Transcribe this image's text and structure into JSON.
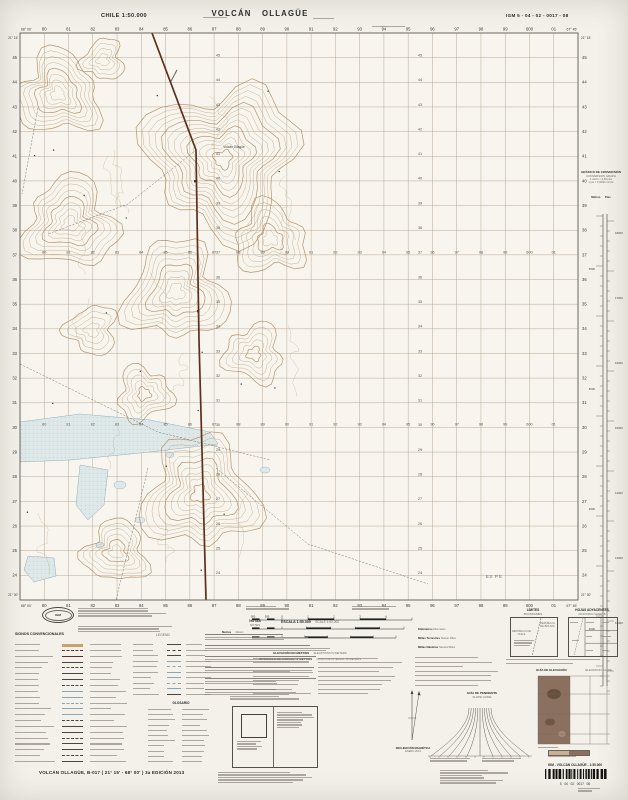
{
  "colors": {
    "paper": "#f7f5ee",
    "grid_line": "#b3a18d",
    "contour": "#b08a5e",
    "road": "#5f2f1d",
    "water_fill": "#dfe8e8",
    "water_line": "#8aa7b4",
    "ink": "#2a2a28",
    "gray": "#6f6b64"
  },
  "header": {
    "country_scale": "CHILE 1:50.000",
    "title": "VOLCÁN OLLAGÜE",
    "sheet_code": "IGM 5 - 04 - 02 - 0017 - 08"
  },
  "map": {
    "corners": {
      "nw_lon": "68° 00'",
      "nw_lat": "21° 15'",
      "ne_lon": "67° 45'",
      "ne_lat": "21° 15'",
      "sw_lon": "68° 00'",
      "sw_lat": "21° 30'",
      "se_lon": "67° 45'",
      "se_lat": "21° 30'"
    },
    "grid": {
      "cols": 23,
      "rows": 23,
      "easting_labels": [
        "80",
        "81",
        "82",
        "83",
        "84",
        "85",
        "86",
        "87",
        "88",
        "89",
        "90",
        "91",
        "92",
        "93",
        "94",
        "95",
        "96",
        "97",
        "98",
        "99",
        "600",
        "01"
      ],
      "northing_labels": [
        "45",
        "44",
        "43",
        "42",
        "41",
        "40",
        "39",
        "38",
        "37",
        "36",
        "35",
        "34",
        "33",
        "32",
        "31",
        "30",
        "29",
        "28",
        "27",
        "26",
        "25",
        "24"
      ]
    },
    "labels": {
      "summit": "Volcán Ollagüe",
      "station": "ES PS"
    }
  },
  "conversion": {
    "title_es": "GRÁFICO DE CONVERSIÓN",
    "title_en": "CONVERSION GRAPH",
    "note1": "1 metro = 3,28 pies",
    "note2": "1 pie = 0,3048 metros",
    "col_es": "Metros",
    "col_en": "Pies",
    "meter_labels": [
      "5500",
      "5000",
      "4500",
      "4000"
    ],
    "feet_labels": [
      "18000",
      "17000",
      "16000",
      "15000",
      "14000",
      "13000",
      "12000"
    ]
  },
  "legend": {
    "signos_es": "SIGNOS CONVENCIONALES",
    "signos_en": "LEGEND",
    "notas_es": "NOTAS",
    "notas_en": "NOTES",
    "escala_es": "ESCALA 1:50.000",
    "escala_en": "SCALE 1:50.000",
    "metros_es": "Metros",
    "metros_en": "Meters",
    "bar_labels": [
      {
        "es": "Kilómetros",
        "en": "Kilometers"
      },
      {
        "es": "Millas Terrestres",
        "en": "Statute Miles"
      },
      {
        "es": "Millas Náuticas",
        "en": "Nautical Miles"
      }
    ],
    "scale_ticks": [
      "1.000",
      "500",
      "0",
      "1",
      "2",
      "3",
      "4"
    ],
    "elev_es": "ELEVACIÓN EN METROS",
    "elev_en": "ELEVATIONS IN METERS",
    "interval_es": "INTERVALO DE CURVAS 50 METROS",
    "interval_en": "CONTOUR INTERVAL 50 METERS",
    "glosario": "GLOSARIO",
    "limites_es": "LÍMITES",
    "limites_en": "BOUNDARIES",
    "limites_bolivia": "REPÚBLICA DE BOLIVIA",
    "limites_chile": "REPÚBLICA DE CHILE",
    "hojas_es": "HOJAS ADYACENTES",
    "hojas_en": "ADJOINING SHEETS",
    "pendiente_es": "GUÍA DE PENDIENTE",
    "pendiente_en": "SLOPE GUIDE",
    "elevguide_es": "GUÍA DE ELEVACIÓN",
    "elevguide_en": "ELEVATION GUIDE",
    "declinacion_1": "DECLINACIÓN MAGNÉTICA",
    "declinacion_2": "ENERO 2013",
    "logo_text": "IGM"
  },
  "footer": {
    "map_title": "VOLCÁN OLLAGÜE, B-017 ( 21° 15' - 68° 00' ) 3a EDICIÓN 2013",
    "barcode_title": "IGM - VOLCÁN OLLAGÜE - 1:50.000",
    "barcode_digits": "5   04   02   0017   08"
  }
}
